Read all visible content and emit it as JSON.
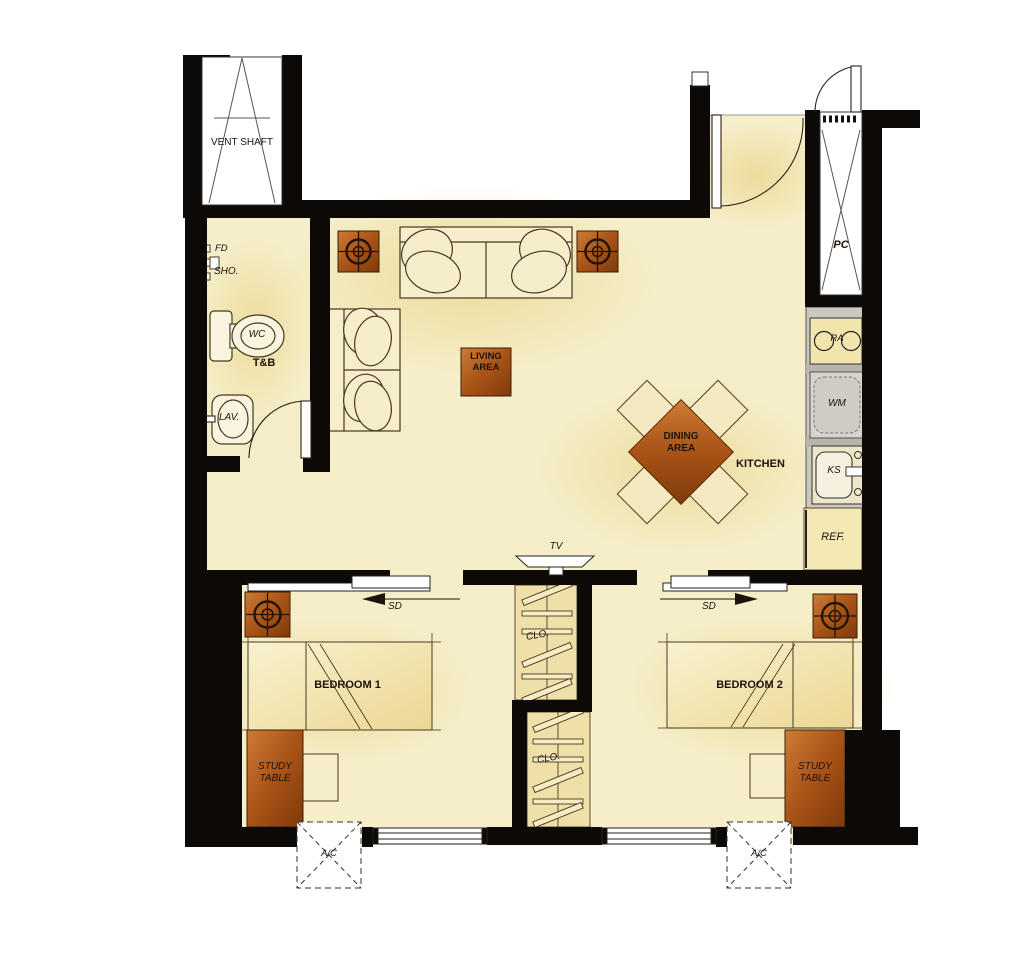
{
  "title": "Two-bedroom unit floor plan",
  "labels": {
    "vent_shaft": "VENT SHAFT",
    "fd": "FD",
    "sho": "SHO.",
    "wc": "WC",
    "tnb": "T&B",
    "lav": "LAV.",
    "living_area": "LIVING\nAREA",
    "dining_area": "DINING\nAREA",
    "kitchen": "KITCHEN",
    "ra": "RA",
    "wm": "WM",
    "ks": "KS",
    "ref": "REF.",
    "pc": "PC",
    "tv": "TV",
    "sd_bedroom1": "SD",
    "sd_bedroom2": "SD",
    "clo_1": "CLO.",
    "clo_2": "CLO.",
    "bedroom1": "BEDROOM 1",
    "bedroom2": "BEDROOM 2",
    "study_table_1": "STUDY\nTABLE",
    "study_table_2": "STUDY\nTABLE",
    "ac_1": "A/C",
    "ac_2": "A/C"
  },
  "colors": {
    "wall": "#0c0906",
    "floor": "#f5eec9",
    "floor_shade": "#e7cf7d",
    "accent_orange": "#a95317",
    "counter_gray": "#cbc8c0",
    "furniture_line": "#473821",
    "text": "#1c130b"
  }
}
